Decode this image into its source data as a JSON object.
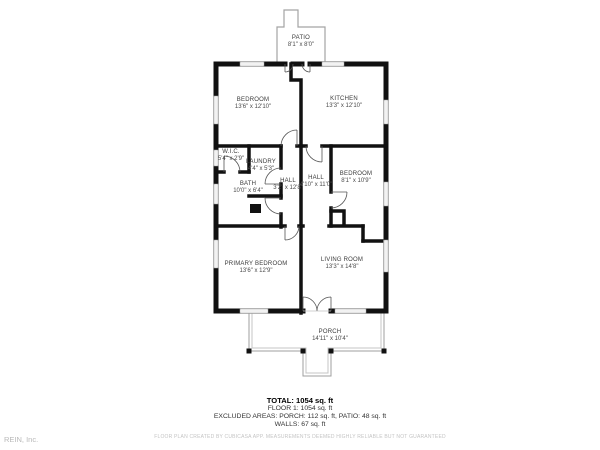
{
  "watermark": "REIN, Inc.",
  "rooms": [
    {
      "id": "patio",
      "name": "PATIO",
      "dims": "8'1\" x 8'0\""
    },
    {
      "id": "bedroom-top",
      "name": "BEDROOM",
      "dims": "13'6\" x 12'10\""
    },
    {
      "id": "kitchen",
      "name": "KITCHEN",
      "dims": "13'3\" x 12'10\""
    },
    {
      "id": "wic",
      "name": "W.I.C.",
      "dims": "5'4\" x 2'9\""
    },
    {
      "id": "laundry",
      "name": "LAUNDRY",
      "dims": "4'4\" x 5'3\""
    },
    {
      "id": "bath",
      "name": "BATH",
      "dims": "10'0\" x 6'4\""
    },
    {
      "id": "hall-side",
      "name": "HALL",
      "dims": "3'2\" x 12'8\""
    },
    {
      "id": "hall-center",
      "name": "HALL",
      "dims": "4'10\" x 11'0\""
    },
    {
      "id": "bedroom-mid",
      "name": "BEDROOM",
      "dims": "8'1\" x 10'9\""
    },
    {
      "id": "primary-bedroom",
      "name": "PRIMARY BEDROOM",
      "dims": "13'6\" x 12'9\""
    },
    {
      "id": "living-room",
      "name": "LIVING ROOM",
      "dims": "13'3\" x 14'8\""
    },
    {
      "id": "porch",
      "name": "PORCH",
      "dims": "14'11\" x 10'4\""
    }
  ],
  "summary": {
    "total": "TOTAL: 1054 sq. ft",
    "floor": "FLOOR 1: 1054 sq. ft",
    "excluded": "EXCLUDED AREAS: PORCH: 112 sq. ft, PATIO: 48 sq. ft",
    "walls": "WALLS: 67 sq. ft"
  },
  "disclaimer": "FLOOR PLAN CREATED BY CUBICASA APP. MEASUREMENTS DEEMED HIGHLY RELIABLE BUT NOT GUARANTEED",
  "colors": {
    "wall": "#111111",
    "window_fill": "#e4e4e4",
    "window_stroke": "#8a8a8a",
    "outline": "#a3a3a3",
    "label_text": "#3b3b3b"
  }
}
